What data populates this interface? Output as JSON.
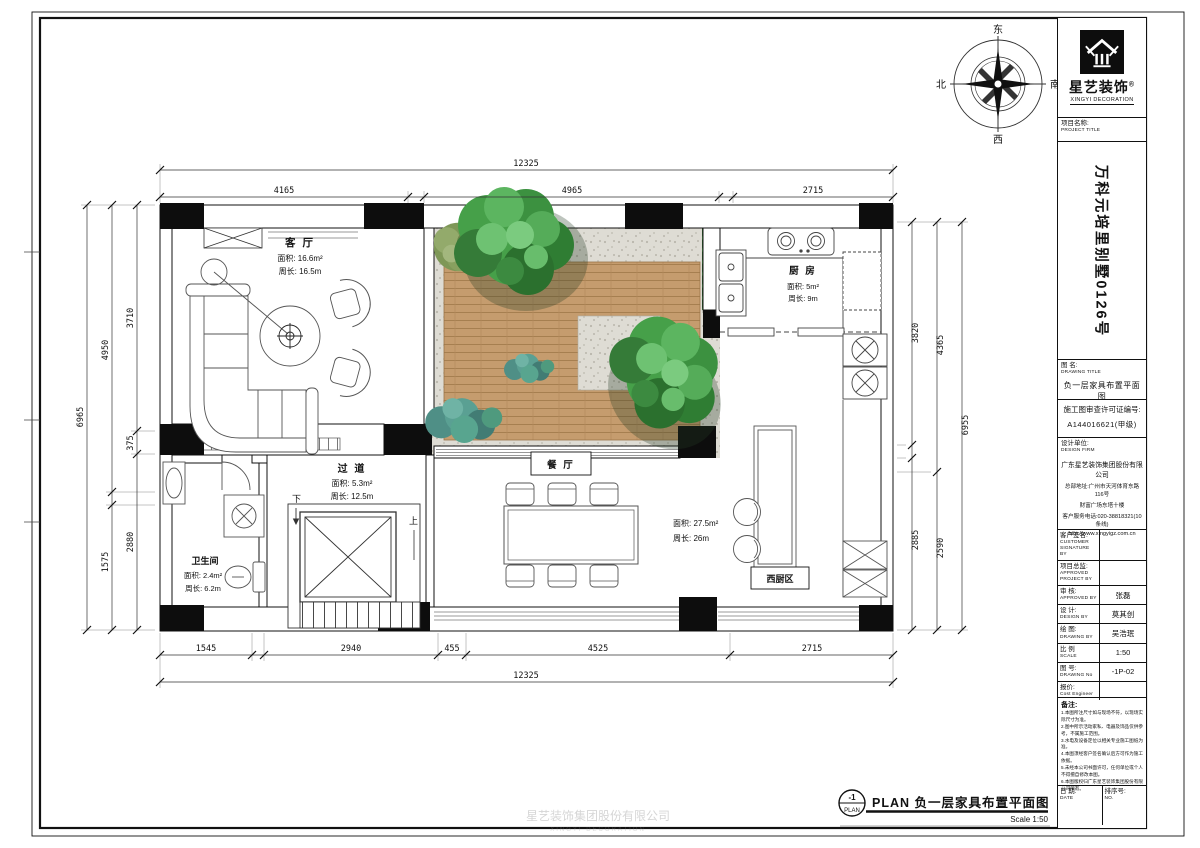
{
  "logo": {
    "brand_cn": "星艺装饰",
    "registered": "®",
    "brand_en": "XINGYI DECORATION"
  },
  "compass": {
    "top": "东",
    "right": "南",
    "bottom": "西",
    "left": "北"
  },
  "title_block": {
    "project_label_cn": "项目名称:",
    "project_label_en": "PROJECT TITLE",
    "project_title": "万科元培里别墅0126号",
    "drawing_label_cn": "图 名:",
    "drawing_label_en": "DRAWING TITLE",
    "drawing_title": "负一层家具布置平面图",
    "permit_label": "施工图审查许可证编号:",
    "permit_no": "A144016621(甲级)",
    "firm_label_cn": "设计单位:",
    "firm_label_en": "DESIGN FIRM",
    "firm_name": "广东星艺装饰集团股份有限公司",
    "firm_address1": "总部地址:广州市天河体育东路116号",
    "firm_address2": "财富广场东塔十楼",
    "firm_phone": "客户服务电话:020-38818321(10条线)",
    "firm_url": "http://www.xingyigz.com.cn",
    "rows": [
      {
        "label_cn": "客户签名:",
        "label_en": "CUSTOMER SIGNATURE BY",
        "value": ""
      },
      {
        "label_cn": "项目总监:",
        "label_en": "APPROVED PROJECT BY",
        "value": ""
      },
      {
        "label_cn": "审 核:",
        "label_en": "APPROVED BY",
        "value": "张磊"
      },
      {
        "label_cn": "设 计:",
        "label_en": "DESIGN BY",
        "value": "莫其创"
      },
      {
        "label_cn": "绘 图:",
        "label_en": "DRAWING BY",
        "value": "吴浩珉"
      },
      {
        "label_cn": "比 例",
        "label_en": "SCALE",
        "value": "1:50"
      },
      {
        "label_cn": "图 号:",
        "label_en": "DRAWING No",
        "value": "-1P-02"
      },
      {
        "label_cn": "报价:",
        "label_en": "Cost Engineer",
        "value": ""
      }
    ],
    "notes_label": "备注:",
    "notes": [
      "1.本图所注尺寸如与现场不符，以现场实际尺寸为准。",
      "2.图中所示活动家私、电器及饰品仅供参考，不属施工范围。",
      "3.水电及设备定位以相关专业施工图纸为准。",
      "4.本图须经客户签名确认后方可作为施工依据。",
      "5.未经本公司书面许可，任何单位或个人不得擅自修改本图。",
      "6.本图版权归广东星艺装饰集团股份有限公司所有。"
    ],
    "date_label_cn": "日 期:",
    "date_label_en": "DATE",
    "no_label_cn": "排序号:",
    "no_label_en": "NO."
  },
  "rooms": {
    "living": {
      "name": "客 厅",
      "area": "面积: 16.6m²",
      "perimeter": "周长: 16.5m"
    },
    "kitchen": {
      "name": "厨 房",
      "area": "面积: 5m²",
      "perimeter": "周长: 9m"
    },
    "corridor": {
      "name": "过 道",
      "area": "面积: 5.3m²",
      "perimeter": "周长: 12.5m"
    },
    "bath": {
      "name": "卫生间",
      "area": "面积: 2.4m²",
      "perimeter": "周长: 6.2m"
    },
    "dining": {
      "name": "餐 厅",
      "area": "面积: 27.5m²",
      "perimeter": "周长: 26m"
    },
    "west_kitchen": {
      "name": "西厨区"
    }
  },
  "stairs": {
    "down": "下",
    "up": "上"
  },
  "dimensions": {
    "top": {
      "overall": "12325",
      "segments": [
        "4165",
        "4965",
        "2715"
      ]
    },
    "bottom": {
      "overall": "12325",
      "segments": [
        "1545",
        "2940",
        "455",
        "4525",
        "2715"
      ]
    },
    "left": {
      "overall": "6965",
      "mid": [
        "4950",
        "1575"
      ],
      "inner": [
        "3710",
        "375",
        "2880"
      ]
    },
    "right": {
      "overall": "6955",
      "mid": [
        "4365",
        "2590"
      ],
      "inner": [
        "3820",
        "2885"
      ]
    }
  },
  "footer": {
    "ref_top": "-1",
    "ref_bottom": "PLAN",
    "title": "PLAN 负一层家具布置平面图",
    "scale": "Scale 1:50"
  },
  "watermark": {
    "line1": "星艺装饰集团股份有限公司",
    "line2": "XINGYI DECORATION"
  },
  "colors": {
    "wood": "#c59c6e",
    "gravel": "#dedcd4",
    "hedge": "#2d662d",
    "tree": "#46a049",
    "ink": "#111111"
  }
}
